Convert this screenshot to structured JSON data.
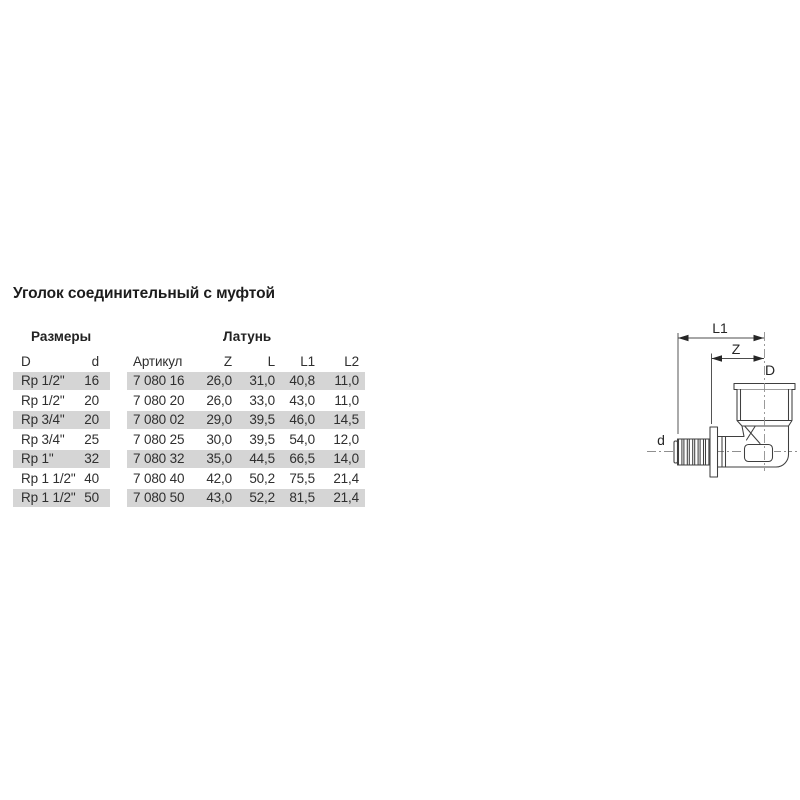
{
  "page": {
    "title": "Уголок соединительный с муфтой"
  },
  "table": {
    "group_headers": {
      "sizes": "Размеры",
      "material": "Латунь"
    },
    "columns": [
      "D",
      "d",
      "Артикул",
      "Z",
      "L",
      "L1",
      "L2"
    ],
    "rows": [
      [
        "Rp 1/2\"",
        "16",
        "7 080 16",
        "26,0",
        "31,0",
        "40,8",
        "11,0"
      ],
      [
        "Rp 1/2\"",
        "20",
        "7 080 20",
        "26,0",
        "33,0",
        "43,0",
        "11,0"
      ],
      [
        "Rp 3/4\"",
        "20",
        "7 080 02",
        "29,0",
        "39,5",
        "46,0",
        "14,5"
      ],
      [
        "Rp 3/4\"",
        "25",
        "7 080 25",
        "30,0",
        "39,5",
        "54,0",
        "12,0"
      ],
      [
        "Rp 1\"",
        "32",
        "7 080 32",
        "35,0",
        "44,5",
        "66,5",
        "14,0"
      ],
      [
        "Rp 1 1/2\"",
        "40",
        "7 080 40",
        "42,0",
        "50,2",
        "75,5",
        "21,4"
      ],
      [
        "Rp 1 1/2\"",
        "50",
        "7 080 50",
        "43,0",
        "52,2",
        "81,5",
        "21,4"
      ]
    ]
  },
  "diagram": {
    "labels": {
      "l1": "L1",
      "z": "Z",
      "d_upper": "D",
      "d_lower": "d"
    }
  },
  "colors": {
    "row_shade": "#d5d5d5",
    "line": "#3f3f3f",
    "centerline": "#8f8f8f",
    "dimension": "#4c4c4c",
    "text": "#2f2f2f"
  }
}
